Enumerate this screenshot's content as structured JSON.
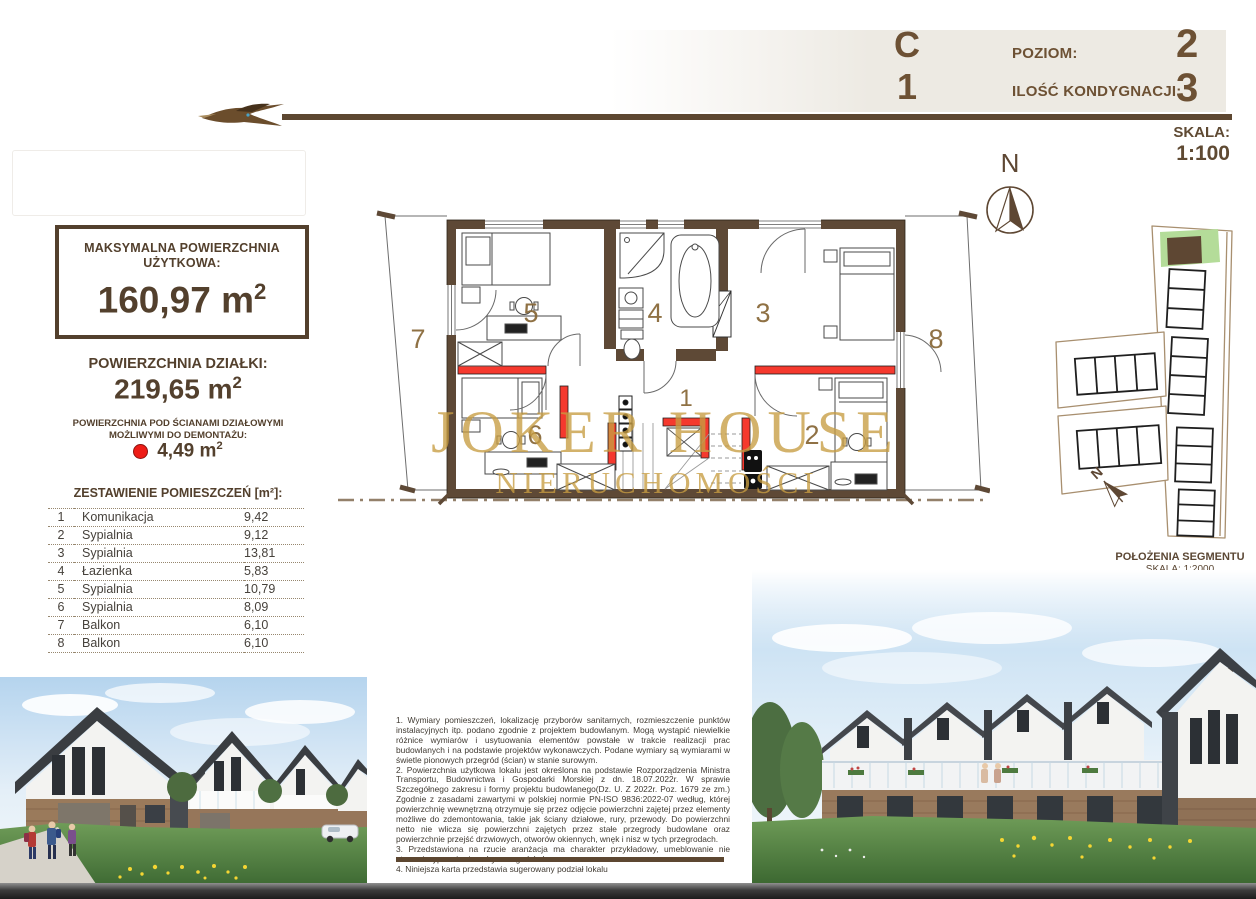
{
  "header": {
    "unit_letter": "C",
    "unit_number": "1",
    "level_label": "POZIOM:",
    "level_value": "2",
    "storeys_label": "ILOŚĆ KONDYGNACJI:",
    "storeys_value": "3",
    "scale_label": "SKALA:",
    "scale_value": "1:100"
  },
  "sidebar": {
    "max_area_title_line1": "MAKSYMALNA POWIERZCHNIA",
    "max_area_title_line2": "UŻYTKOWA:",
    "max_area_value": "160,97",
    "unit_m": "m",
    "unit_sup": "2",
    "plot_area_label": "POWIERZCHNIA DZIAŁKI:",
    "plot_area_value": "219,65",
    "partition_note_line1": "POWIERZCHNIA POD ŚCIANAMI DZIAŁOWYMI",
    "partition_note_line2": "MOŻLIWYMI DO DEMONTAŻU:",
    "partition_value": "4,49",
    "table_title": "ZESTAWIENIE POMIESZCZEŃ [m²]:",
    "rooms": [
      {
        "no": "1",
        "name": "Komunikacja",
        "area": "9,42"
      },
      {
        "no": "2",
        "name": "Sypialnia",
        "area": "9,12"
      },
      {
        "no": "3",
        "name": "Sypialnia",
        "area": "13,81"
      },
      {
        "no": "4",
        "name": "Łazienka",
        "area": "5,83"
      },
      {
        "no": "5",
        "name": "Sypialnia",
        "area": "10,79"
      },
      {
        "no": "6",
        "name": "Sypialnia",
        "area": "8,09"
      },
      {
        "no": "7",
        "name": "Balkon",
        "area": "6,10"
      },
      {
        "no": "8",
        "name": "Balkon",
        "area": "6,10"
      }
    ]
  },
  "plan": {
    "watermark_line1": "JOKER HOUSE",
    "watermark_line2": "NIERUCHOMOŚCI",
    "compass_north": "N",
    "room_labels": {
      "r1": "1",
      "r2": "2",
      "r3": "3",
      "r4": "4",
      "r5": "5",
      "r6": "6",
      "r7": "7",
      "r8": "8"
    }
  },
  "sitemap": {
    "caption": "POŁOŻENIA SEGMENTU",
    "scale": "SKALA: 1:2000",
    "compass_north": "N"
  },
  "notes": {
    "items": [
      "1. Wymiary pomieszczeń, lokalizację przyborów sanitarnych, rozmieszczenie punktów instalacyjnych itp. podano zgodnie z projektem budowlanym. Mogą wystąpić niewielkie różnice wymiarów i usytuowania elementów powstałe w trakcie realizacji prac budowlanych i na podstawie projektów wykonawczych. Podane wymiary są wymiarami w świetle pionowych przegród (ścian) w stanie surowym.",
      "2. Powierzchnia użytkowa lokalu jest określona na podstawie Rozporządzenia Ministra Transportu, Budownictwa i Gospodarki Morskiej z dn. 18.07.2022r. W sprawie Szczegółnego zakresu i formy projektu budowlanego(Dz. U. Z 2022r. Poz. 1679 ze zm.) Zgodnie z zasadami zawartymi w polskiej normie PN-ISO 9836:2022-07 według, której powierzchnię wewnętrzną otrzymuje się przez odjęcie powierzchni zajętej przez elementy możliwe do zdemontowania, takie jak ściany działowe, rury, przewody. Do powierzchni netto nie wlicza się powierzchni zajętych przez stałe przegrody budowlane oraz powierzchnie przejść drzwiowych, otworów okiennych, wnęk i nisz w tych przegrodach.",
      "3. Przedstawiona na rzucie aranżacja ma charakter przykładowy, umeblowanie nie stanowi wyposażenia nabywanego lokalu.",
      "4. Niniejsza karta przedstawia sugerowany podział lokalu"
    ]
  },
  "colors": {
    "brown": "#5b4734",
    "brown_text": "#6d5134",
    "red": "#f5392e",
    "gold": "#c79d42",
    "green_highlight": "#b4dc99",
    "band_beige": "#edeae3"
  }
}
